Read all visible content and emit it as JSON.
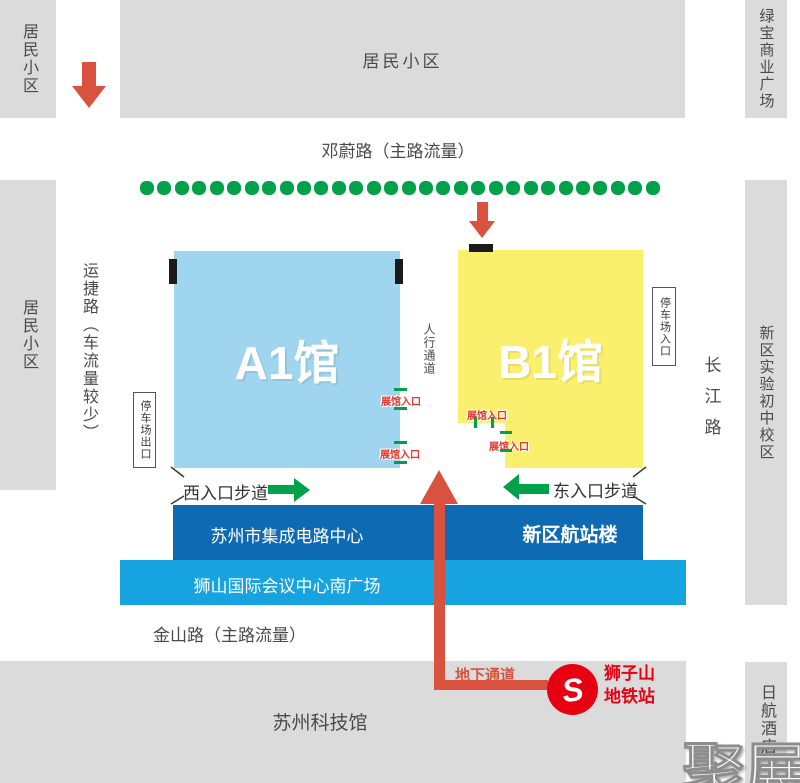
{
  "blocks": {
    "top_left": "居民小区",
    "top": "居民小区",
    "top_right": "绿宝商业广场",
    "left": "居民小区",
    "right": "新区实验初中校区",
    "bottom": "苏州科技馆",
    "bottom_right": "日航酒店"
  },
  "roads": {
    "top": "邓蔚路（主路流量）",
    "left": "运捷路（车流量较少）",
    "right": "长江路",
    "bottom": "金山路（主路流量）",
    "pedestrian": "人行通道"
  },
  "halls": {
    "a1": "A1馆",
    "b1": "B1馆",
    "entrance_label": "展馆入口",
    "parking_exit": "停车场出口",
    "parking_entrance": "停车场入口"
  },
  "walkways": {
    "west": "西入口步道",
    "east": "东入口步道"
  },
  "venues": {
    "ic_center": "苏州市集成电路中心",
    "terminal": "新区航站楼",
    "plaza": "狮山国际会议中心南广场"
  },
  "metro": {
    "passage": "地下通道",
    "station_line1": "狮子山",
    "station_line2": "地铁站",
    "logo_letter": "S"
  },
  "watermark": "聚展",
  "decor": {
    "roadside_dots_count": 30
  },
  "colors": {
    "block_gray": "#dbdbdb",
    "hall_a1": "#9fd5ef",
    "hall_b1": "#fbf06d",
    "green": "#00a14b",
    "dark_blue": "#0f6ab4",
    "light_blue": "#17a2e0",
    "route_red": "#d9523f",
    "metro_red": "#e60012",
    "entrance_red": "#e8342a"
  }
}
